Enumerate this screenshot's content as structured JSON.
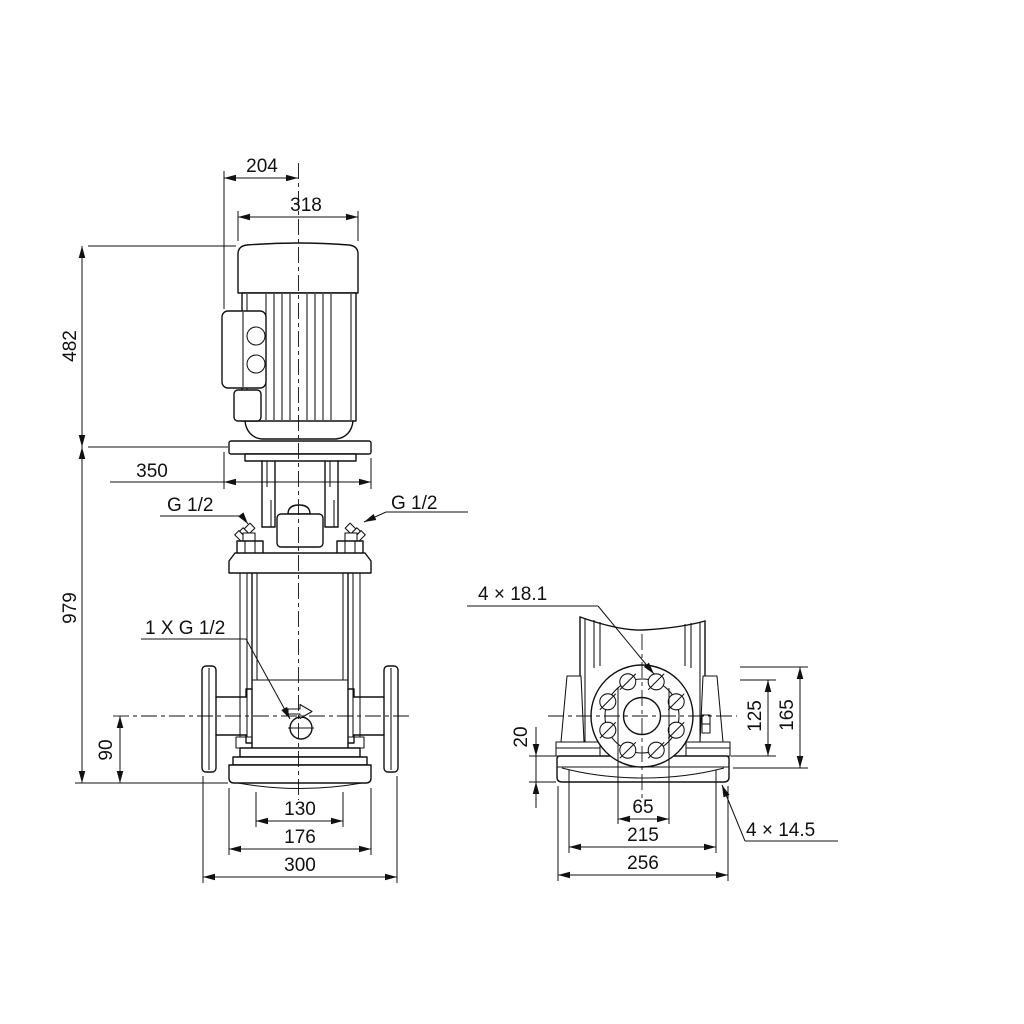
{
  "drawing": {
    "kind": "pump dimensional drawing",
    "views": {
      "front": "front elevation with motor",
      "side": "flange end view with base plate"
    }
  },
  "front_view": {
    "dims": {
      "d204": "204",
      "d318": "318",
      "d482": "482",
      "d350": "350",
      "d979": "979",
      "d90": "90",
      "d130": "130",
      "d176": "176",
      "d300": "300"
    },
    "labels": {
      "plug_left": "G 1/2",
      "plug_right": "G 1/2",
      "drain": "1 X G 1/2"
    }
  },
  "side_view": {
    "dims": {
      "d20": "20",
      "d125": "125",
      "d165": "165",
      "d65": "65",
      "d215": "215",
      "d256": "256"
    },
    "labels": {
      "flange_holes": "4 × 18.1",
      "base_holes": "4 × 14.5"
    }
  },
  "colors": {
    "line": "#111111",
    "background": "#ffffff"
  }
}
